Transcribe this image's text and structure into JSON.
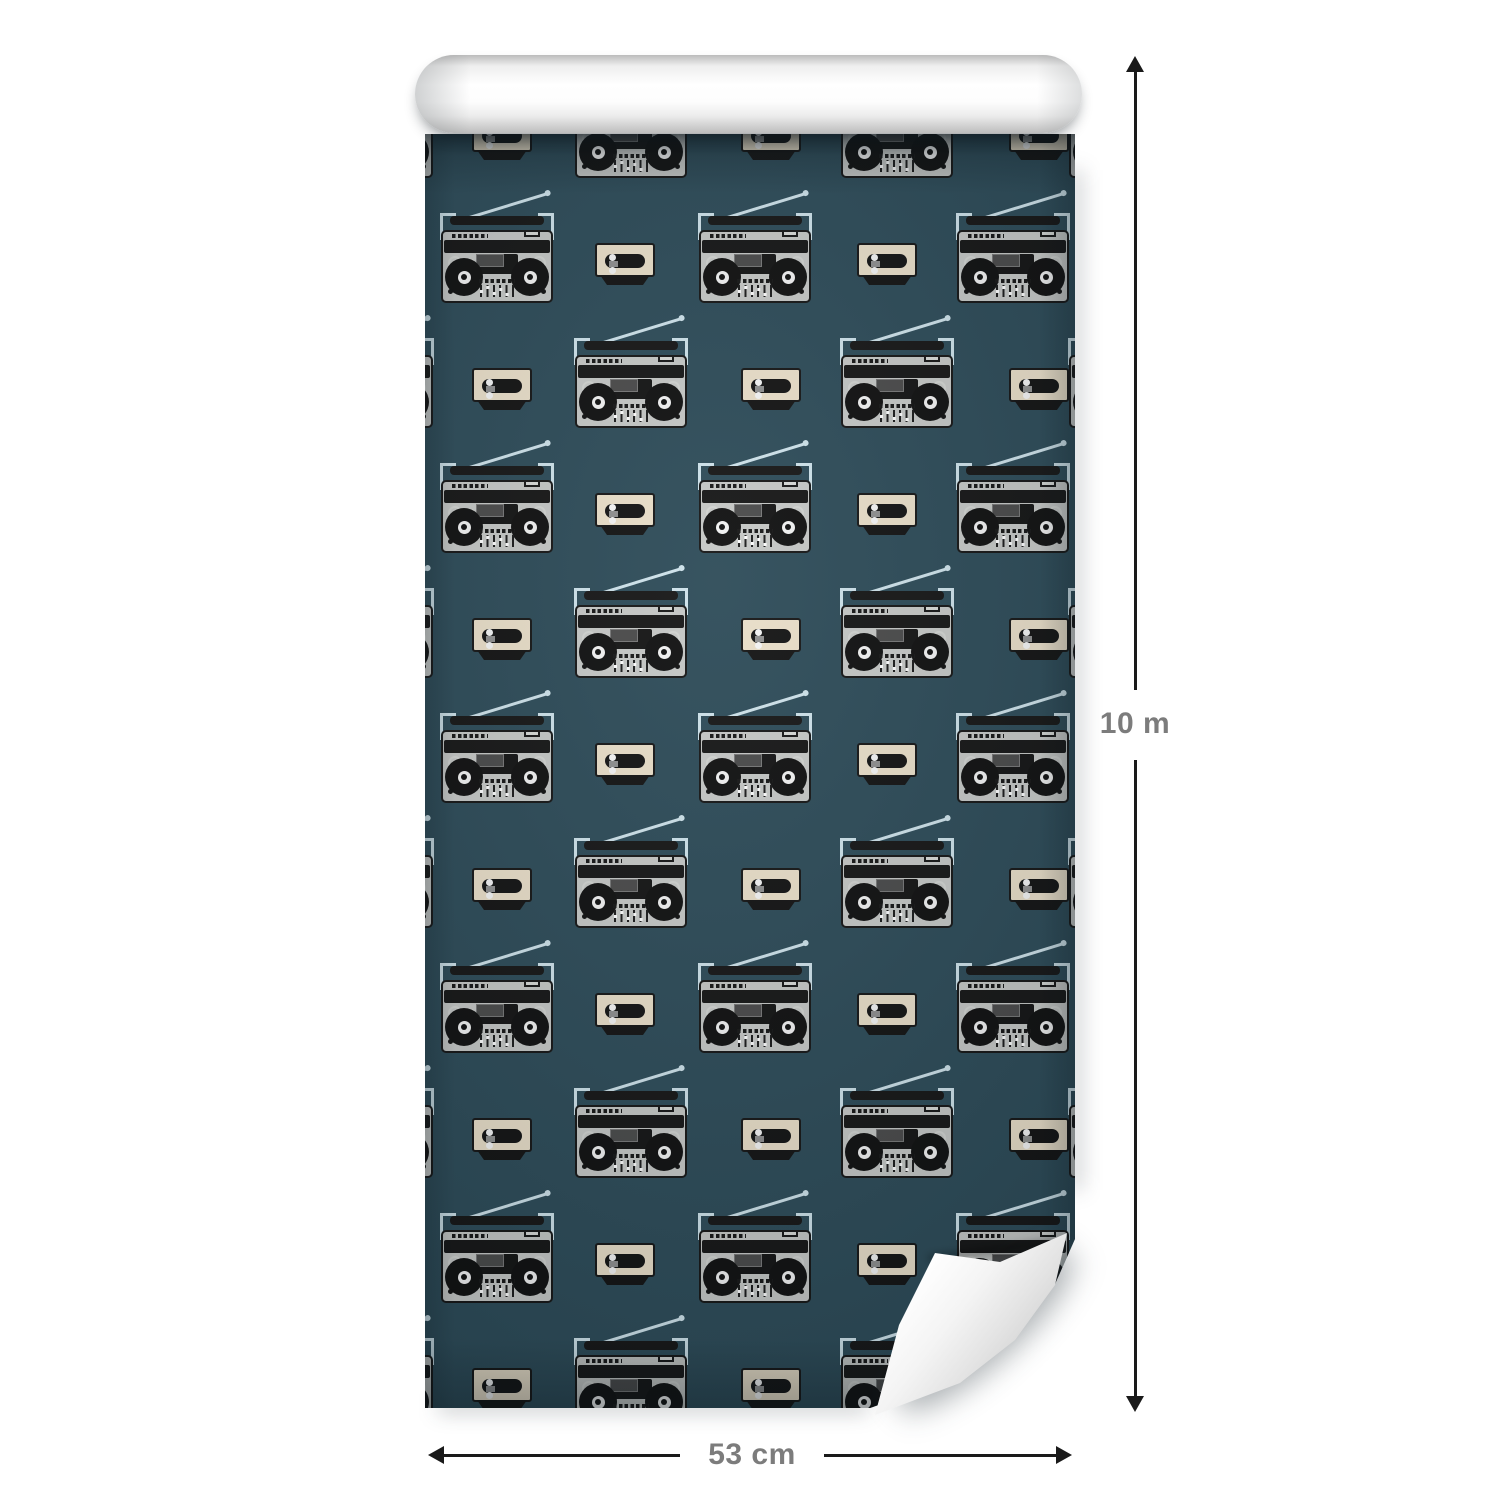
{
  "dimensions": {
    "height_label": "10 m",
    "width_label": "53 cm"
  },
  "colors": {
    "page_background": "#ffffff",
    "wallpaper_teal": "#2d4b58",
    "boombox_gray": "#c6c8c6",
    "cassette_cream": "#eadfc9",
    "accent_light": "#cfe3eb",
    "ink": "#161616",
    "arrow_black": "#1a1a1a",
    "dimension_label_gray": "#7c7c7c",
    "roll_white": "#ffffff"
  },
  "pattern": {
    "motifs": [
      "boombox",
      "cassette"
    ],
    "first_row_center_y": 140,
    "row_spacing": 125,
    "row_count": 11,
    "first_row_type": "B",
    "type_A": {
      "boombox_x": [
        72,
        330,
        588
      ],
      "cassette_x": [
        200,
        462
      ]
    },
    "type_B": {
      "boombox_x": [
        -48,
        206,
        472,
        700
      ],
      "cassette_x": [
        77,
        346,
        614
      ]
    }
  }
}
